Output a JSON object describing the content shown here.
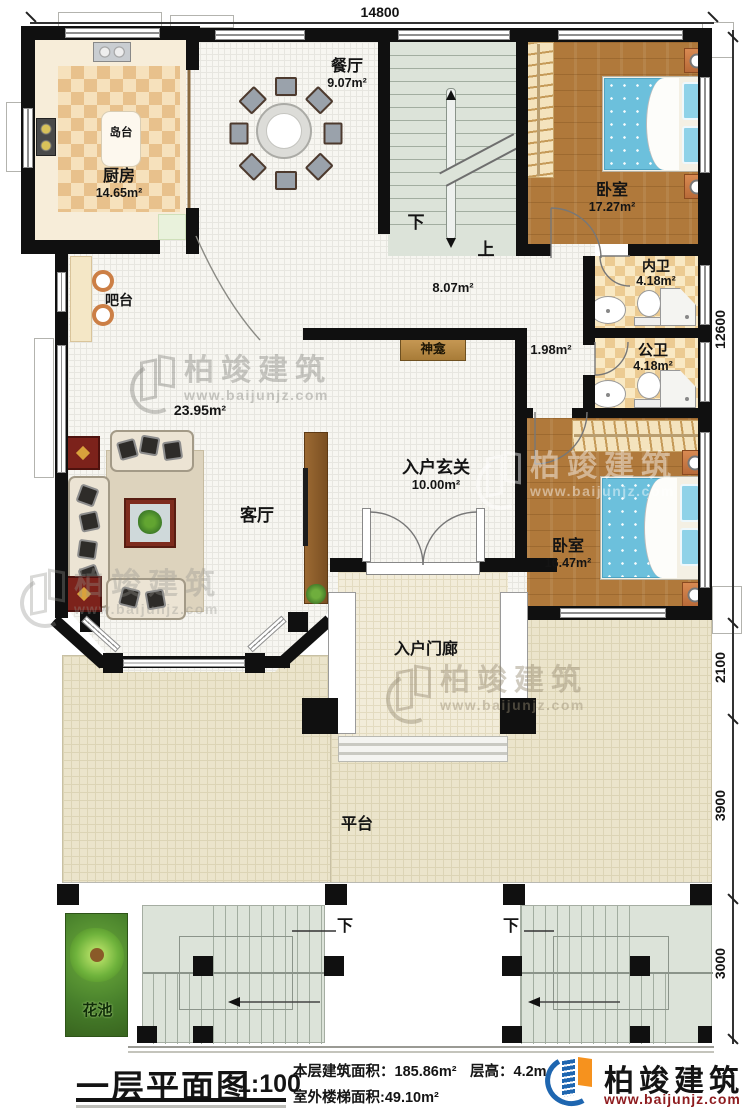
{
  "watermark": {
    "brand": "柏竣建筑",
    "url": "www.baijunjz.com"
  },
  "dimensions": {
    "top": "14800",
    "right_main": "12600",
    "right_porch": "2100",
    "right_platform": "3900",
    "right_stairs": "3000"
  },
  "rooms": {
    "dining": {
      "name": "餐厅",
      "area": "9.07m²"
    },
    "kitchen": {
      "name": "厨房",
      "area": "14.65m²"
    },
    "island": {
      "name": "岛台"
    },
    "bar": {
      "name": "吧台"
    },
    "bedroom1": {
      "name": "卧室",
      "area": "17.27m²"
    },
    "inner_bath": {
      "name": "内卫",
      "area": "4.18m²"
    },
    "public_bath": {
      "name": "公卫",
      "area": "4.18m²"
    },
    "hall": {
      "area": "8.07m²"
    },
    "niche": {
      "area": "1.98m²"
    },
    "shrine": {
      "name": "神龛"
    },
    "living": {
      "name": "客厅",
      "area": "23.95m²"
    },
    "foyer": {
      "name": "入户玄关",
      "area": "10.00m²"
    },
    "bedroom2": {
      "name": "卧室",
      "area": "16.47m²"
    },
    "porch": {
      "name": "入户门廊"
    },
    "platform": {
      "name": "平台"
    },
    "flower_bed": {
      "name": "花池"
    }
  },
  "stairs": {
    "indoor_down": "下",
    "indoor_up": "上",
    "outdoor_left_down": "下",
    "outdoor_right_down": "下"
  },
  "title_block": {
    "title": "一层平面图",
    "scale": "1:100",
    "floor_area_label": "本层建筑面积：",
    "floor_area_value": "185.86m²",
    "height_label": "层高：",
    "height_value": "4.2m",
    "stair_area_label": "室外楼梯面积:",
    "stair_area_value": "49.10m²",
    "brand": "柏竣建筑",
    "brand_url": "www.baijunjz.com"
  },
  "colors": {
    "wall": "#101010",
    "wood_floor": "#b0793b",
    "bed_blue": "#6cc0dc",
    "bath_checker": "#eccb92",
    "platform_tan": "#ebe4cb",
    "brand_blue": "#1e66b0",
    "brand_orange": "#f6921e",
    "brand_red": "#8e1b1e"
  }
}
